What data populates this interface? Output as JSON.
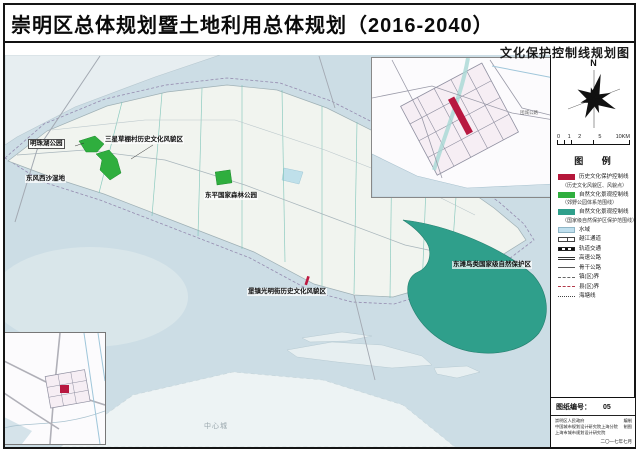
{
  "title": "崇明区总体规划暨土地利用总体规划（2016-2040）",
  "subtitle": "文化保护控制线规划图",
  "compass": {
    "north_label": "N"
  },
  "scale_bar": {
    "ticks": [
      "0 1 2",
      "5",
      "10KM"
    ]
  },
  "legend": {
    "header": "图  例",
    "items": [
      {
        "label": "历史文化保护控制线",
        "swatch": "red"
      },
      {
        "label": "（历史文化风貌区、风貌点）",
        "swatch": "none"
      },
      {
        "label": "自然文化景观控制线",
        "swatch": "green"
      },
      {
        "label": "（郊野公园体系范围线）",
        "swatch": "none"
      },
      {
        "label": "自然文化景观控制线",
        "swatch": "teal"
      },
      {
        "label": "（国家级自然保护区保护范围线）",
        "swatch": "none"
      },
      {
        "label": "水域",
        "swatch": "water"
      },
      {
        "label": "越江通道",
        "swatch": "tunnel"
      },
      {
        "label": "轨道交通",
        "swatch": "rail"
      },
      {
        "label": "高速公路",
        "swatch": "highway"
      },
      {
        "label": "骨干公路",
        "swatch": "road"
      },
      {
        "label": "镇(区)界",
        "swatch": "boundary-town"
      },
      {
        "label": "县(区)界",
        "swatch": "boundary-county"
      },
      {
        "label": "海塘线",
        "swatch": "seawall"
      }
    ]
  },
  "map_labels": [
    {
      "text": "明珠湖公园"
    },
    {
      "text": "东风西沙湿地"
    },
    {
      "text": "三星草棚村历史文化风貌区"
    },
    {
      "text": "东平国家森林公园"
    },
    {
      "text": "堡镇光明街历史文化风貌区"
    },
    {
      "text": "东滩鸟类国家级自然保护区"
    },
    {
      "text": "中心城"
    }
  ],
  "inset_labels": {
    "road": "团城公路"
  },
  "title_block": {
    "drawing_no_label": "图纸编号：",
    "drawing_no": "05",
    "credits": [
      {
        "name": "崇明区人民政府",
        "role": "编制"
      },
      {
        "name": "中国城市规划设计研究院上海分院",
        "role": "制图"
      },
      {
        "name": "上海市城市规划设计研究院",
        "role": ""
      }
    ],
    "date": "二〇一七年七月"
  },
  "colors": {
    "water": "#ccdde5",
    "island": "#f1f4ef",
    "historic_red": "#b5173a",
    "park_green": "#2fae3e",
    "reserve_teal": "#2f9f8b",
    "boundary_purple": "#8b7da6"
  }
}
